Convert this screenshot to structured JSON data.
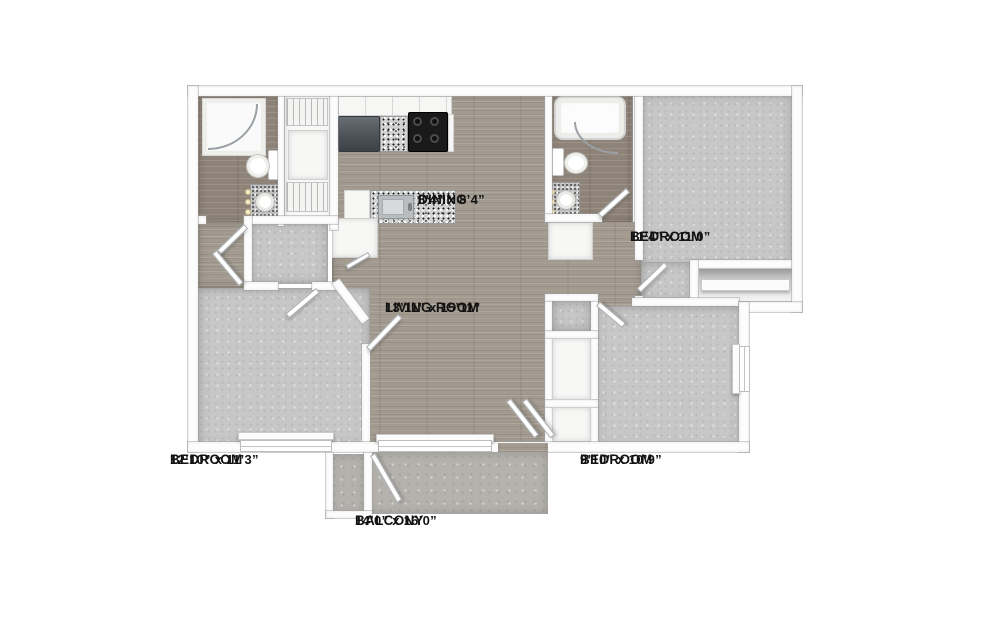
{
  "rooms": [
    {
      "id": "dining",
      "name": "DINING",
      "dims": "8’4” x 8’4”"
    },
    {
      "id": "bedroom-top-right",
      "name": "BEDROOM",
      "dims": "11’4” x 11’0”"
    },
    {
      "id": "living-room",
      "name": "LIVING ROOM",
      "dims": "13’11” x 15’11”"
    },
    {
      "id": "bedroom-bottom-left",
      "name": "BEDROOM",
      "dims": "12’10” x 11’3”"
    },
    {
      "id": "bedroom-bottom-right",
      "name": "BEDROOM",
      "dims": "9’10” x 10’9”"
    },
    {
      "id": "balcony",
      "name": "BALCONY",
      "dims": "14’0” x 16’0”"
    }
  ],
  "fixtures": [
    "shower",
    "toilet",
    "vanity-sink",
    "vanity-lights",
    "bathtub",
    "refrigerator",
    "stove",
    "kitchen-sink",
    "kitchen-island",
    "pantry-cabinet",
    "wire-shelving",
    "closet-shelf",
    "door-swing",
    "window",
    "french-doors",
    "balcony-storage-closet",
    "linen-closet"
  ],
  "colors": {
    "wall": "#fdfdfd",
    "wood": "#a39b90",
    "wood_dark": "#8e8378",
    "carpet": "#c7c7c7",
    "concrete": "#b5b2ae",
    "label_text": "#131313"
  }
}
